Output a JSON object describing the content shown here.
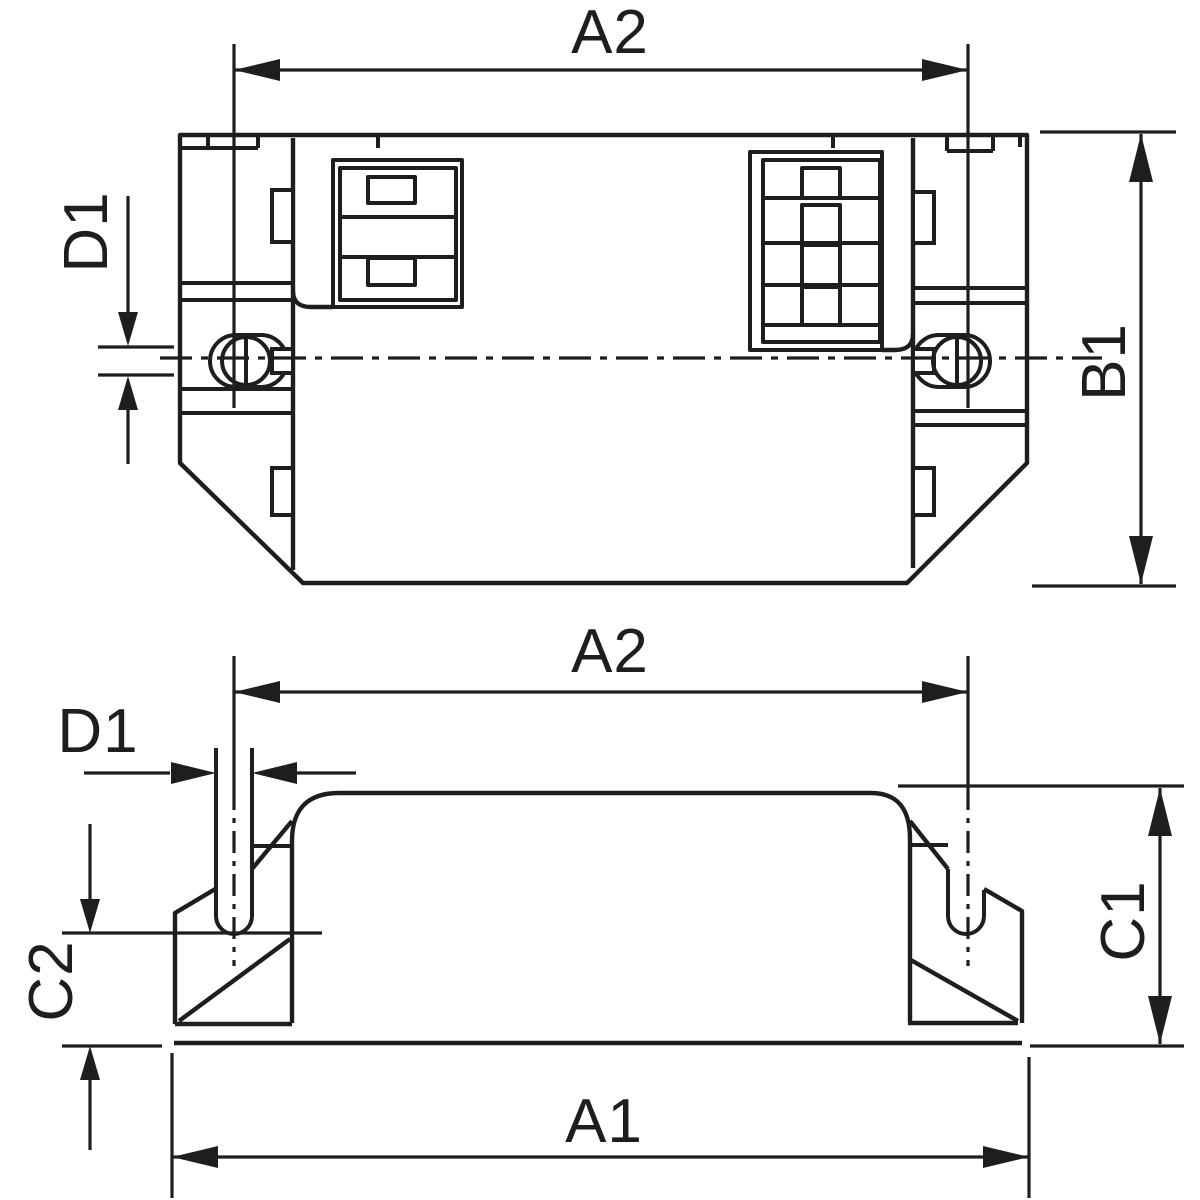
{
  "drawing": {
    "background": "#ffffff",
    "line_color": "#1e1e1e",
    "views": {
      "top_view": {
        "dim_a2": "A2",
        "dim_d1": "D1",
        "dim_b1": "B1"
      },
      "side_view": {
        "dim_a2": "A2",
        "dim_d1": "D1",
        "dim_c2": "C2",
        "dim_c1": "C1",
        "dim_a1": "A1"
      }
    }
  }
}
